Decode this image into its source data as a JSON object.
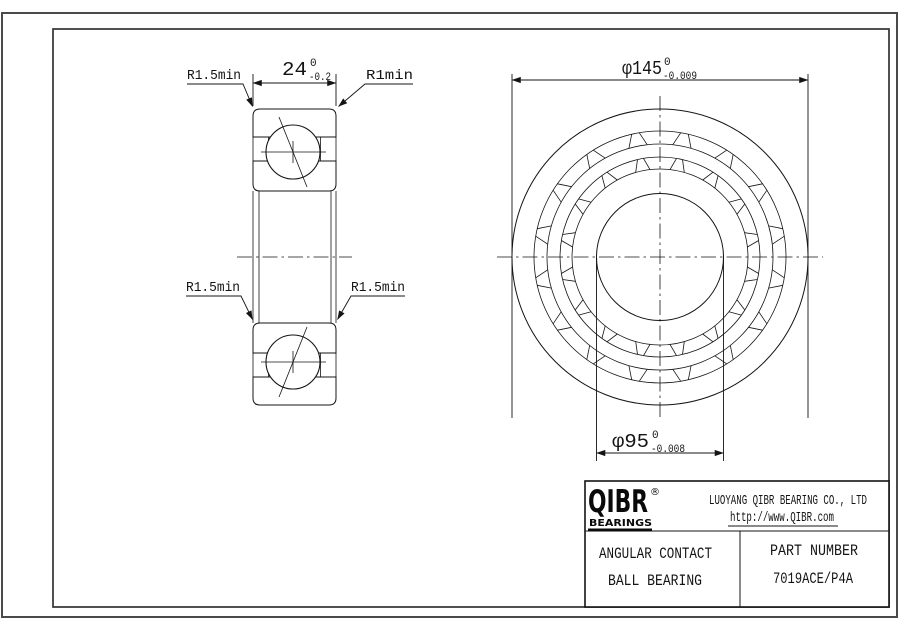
{
  "sheet": {
    "background": "#ffffff",
    "line_color": "#141414"
  },
  "section_view": {
    "width_dim": {
      "value": "24",
      "tol_upper": "0",
      "tol_lower": "-0.2"
    },
    "fillet_top_left": "R1.5min",
    "fillet_top_right": "R1min",
    "fillet_bottom_left": "R1.5min",
    "fillet_bottom_right": "R1.5min"
  },
  "front_view": {
    "outer_dia": {
      "value": "φ145",
      "tol_upper": "0",
      "tol_lower": "-0.009"
    },
    "bore_dia": {
      "value": "φ95",
      "tol_upper": "0",
      "tol_lower": "-0.008"
    }
  },
  "title_block": {
    "brand": "QIBR",
    "registered": "®",
    "brand_sub": "BEARINGS",
    "company": "LUOYANG QIBR BEARING CO., LTD",
    "website": "http://www.QIBR.com",
    "product_line1": "ANGULAR CONTACT",
    "product_line2": "BALL BEARING",
    "part_label": "PART NUMBER",
    "part_number": "7019ACE/P4A"
  }
}
